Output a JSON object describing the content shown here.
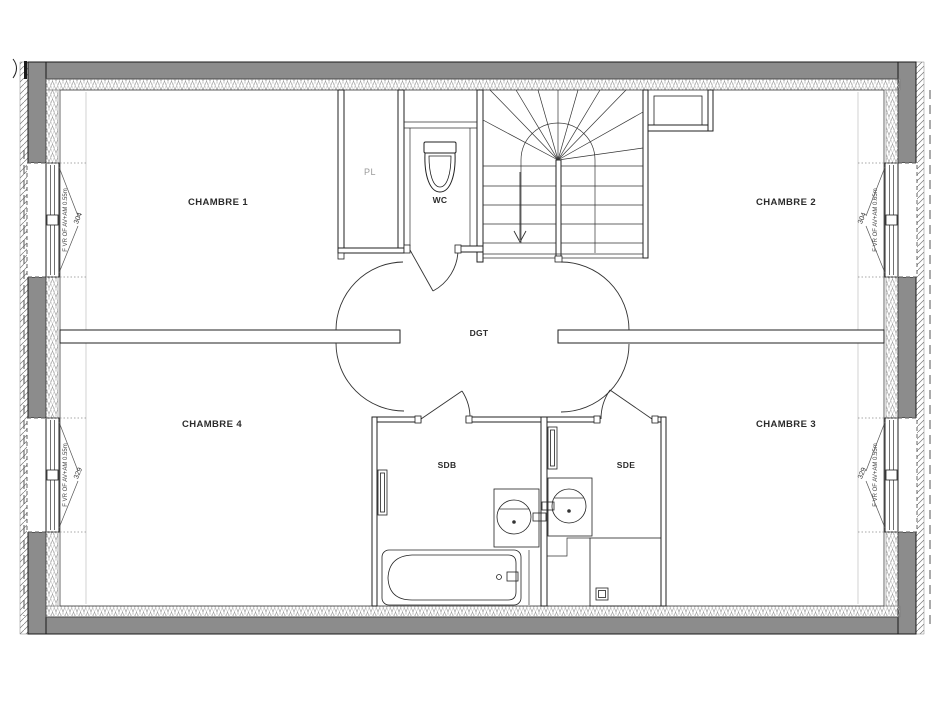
{
  "plan": {
    "title": "floor-plan-etage",
    "rooms": {
      "chambre1": {
        "label": "CHAMBRE 1"
      },
      "chambre2": {
        "label": "CHAMBRE 2"
      },
      "chambre3": {
        "label": "CHAMBRE 3"
      },
      "chambre4": {
        "label": "CHAMBRE 4"
      },
      "pl": {
        "label": "PL"
      },
      "wc": {
        "label": "WC"
      },
      "dgt": {
        "label": "DGT"
      },
      "sdb": {
        "label": "SDB"
      },
      "sde": {
        "label": "SDE"
      }
    },
    "windows": {
      "top_left": {
        "spec": "F VR OF AV+AM 0.55m",
        "dim": "304"
      },
      "top_right": {
        "spec": "F VR OF AV+AM 0.65m",
        "dim": "304"
      },
      "bottom_left": {
        "spec": "F VR OF AV+AM 0.55m",
        "dim": "329"
      },
      "bottom_right": {
        "spec": "F VR OF AV+AM 0.55m",
        "dim": "329"
      }
    },
    "colors": {
      "wall": "#8c8c8c",
      "line": "#222222",
      "background": "#ffffff"
    }
  }
}
